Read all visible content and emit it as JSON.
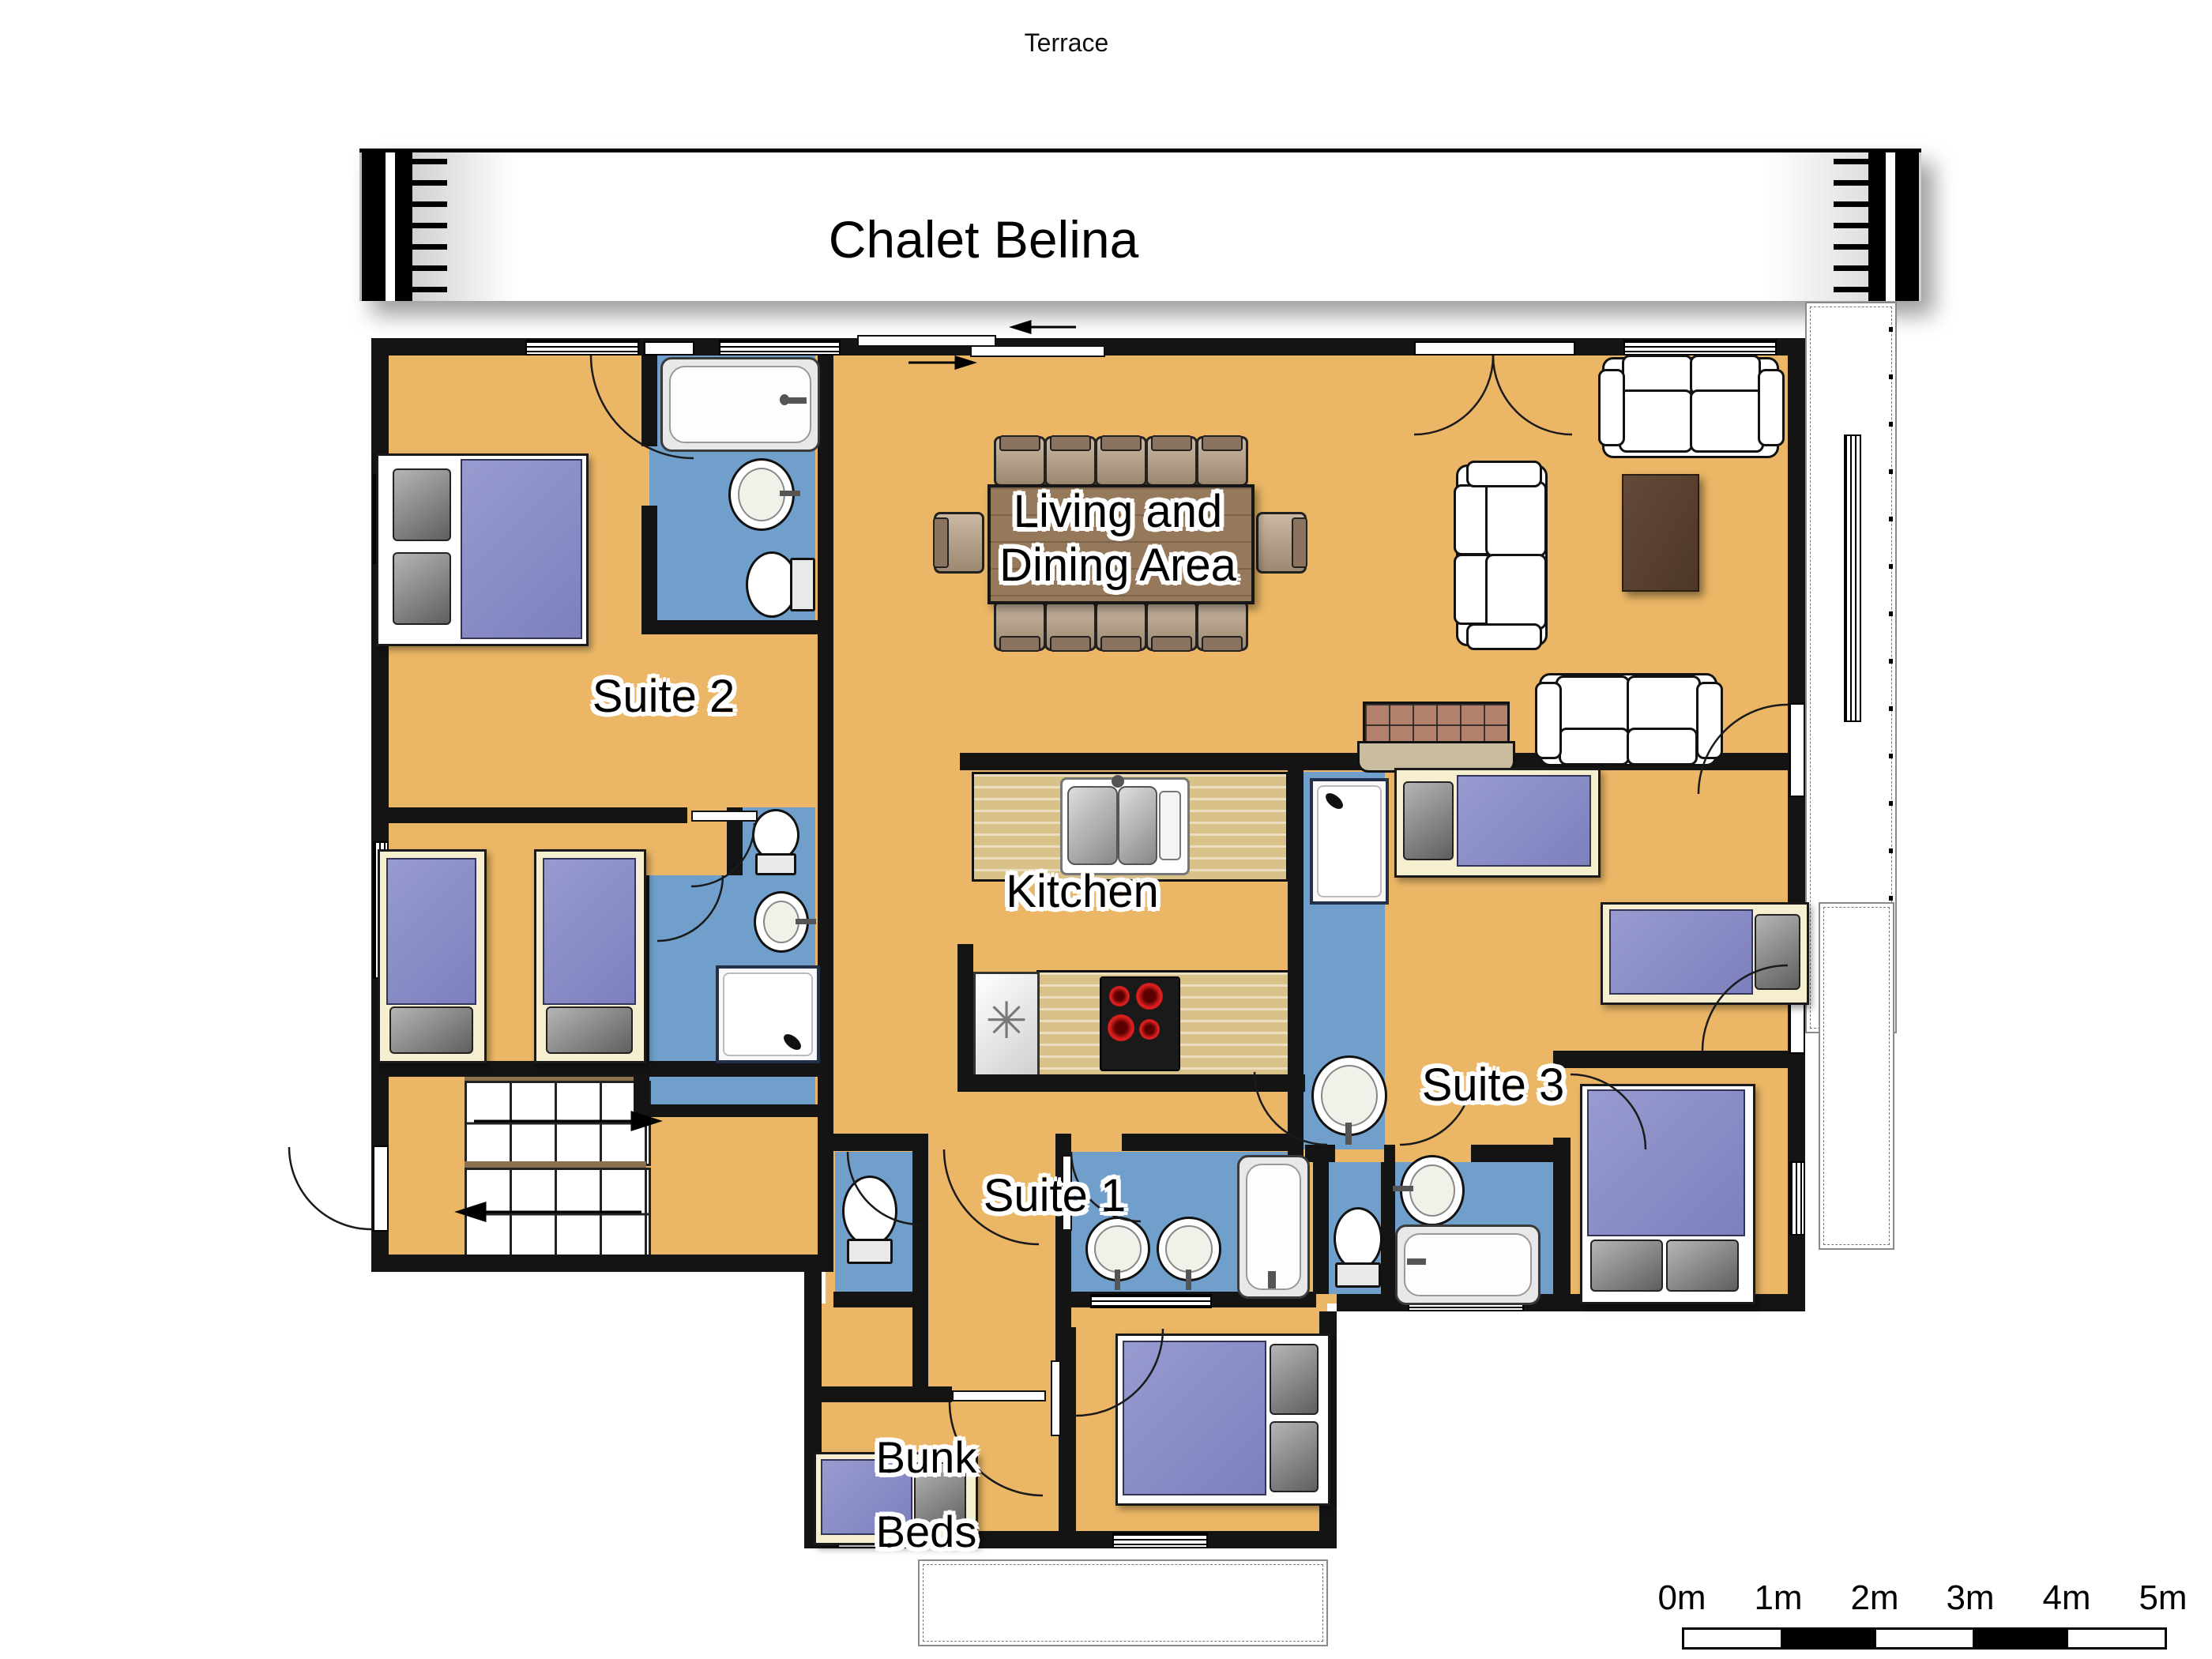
{
  "banner": {
    "title": "Chalet Belina"
  },
  "labels": {
    "terrace": "Terrace"
  },
  "rooms": {
    "living_dining": {
      "line1": "Living and",
      "line2": "Dining Area"
    },
    "kitchen": {
      "label": "Kitchen"
    },
    "suite1": {
      "label": "Suite 1"
    },
    "suite2": {
      "label": "Suite 2"
    },
    "suite3": {
      "label": "Suite 3"
    },
    "bunk": {
      "line1": "Bunk",
      "line2": "Beds"
    }
  },
  "scale_bar": {
    "labels": [
      "0m",
      "1m",
      "2m",
      "3m",
      "4m",
      "5m"
    ]
  },
  "colors": {
    "floor": "#ebb766",
    "bathroom": "#6f9fca",
    "wall": "#141414",
    "bed_duvet": "#8487c4",
    "bed_frame_cream": "#f6efcf",
    "counter_wood": "#d8c289",
    "dining_table": "#96795a",
    "coffee_table": "#5a4231",
    "fireplace_brick": "#b3806b",
    "sofa": "#ffffff",
    "terrace_outline": "#8a8a8a"
  },
  "icons": {
    "freezer_glyph": "✳"
  }
}
